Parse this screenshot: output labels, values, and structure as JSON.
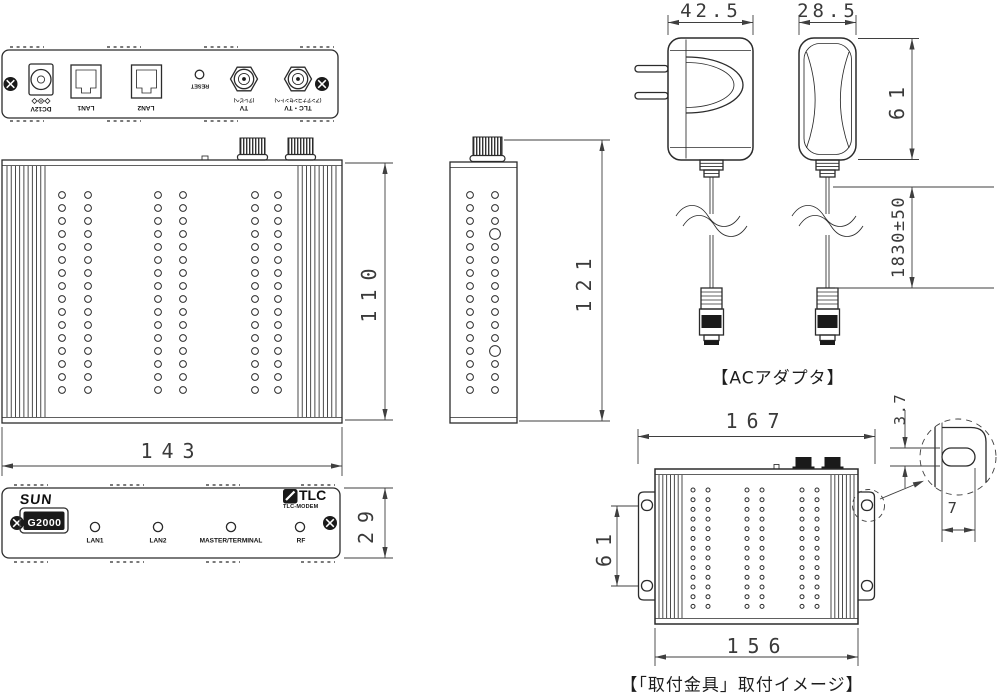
{
  "colors": {
    "line": "#2b2b2b",
    "dim_text": "#3a3a3a"
  },
  "rear_panel": {
    "dc12v": "DC12V",
    "lan1": "LAN1",
    "lan2": "LAN2",
    "reset": "RESET",
    "tv": "TV",
    "tv_note": "(テレビへ)",
    "tlc_tv": "TLC・TV",
    "tlc_tv_note": "(アンテナコンセントへ)"
  },
  "top_view": {
    "width": "143",
    "height": "110"
  },
  "side_view": {
    "height": "121"
  },
  "front_panel": {
    "brand": "SUN",
    "model": "G2000",
    "logo": "TLC",
    "logo_sub": "TLC-MODEM",
    "led_lan1": "LAN1",
    "led_lan2": "LAN2",
    "led_master": "MASTER/TERMINAL",
    "led_rf": "RF",
    "height": "29"
  },
  "ac_adapter": {
    "caption": "【ACアダプタ】",
    "width_side": "42.5",
    "width_front": "28.5",
    "height": "61",
    "cable_length": "1830±50"
  },
  "mount_view": {
    "caption": "【「取付金具」取付イメージ】",
    "width_overall": "167",
    "width_body": "156",
    "hole_pitch": "61",
    "slot_height": "3.7",
    "slot_width": "7"
  }
}
